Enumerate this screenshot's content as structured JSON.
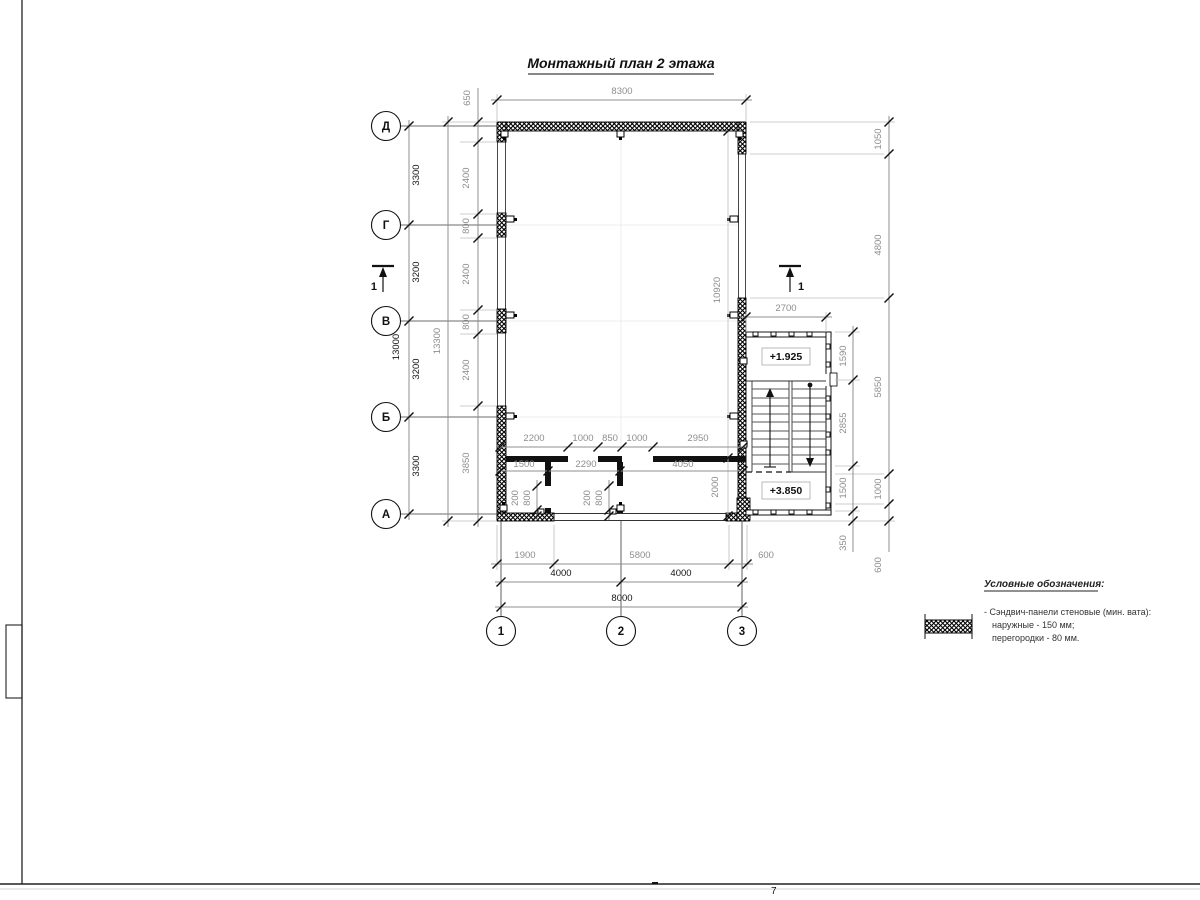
{
  "title": "Монтажный план 2 этажа",
  "axes": {
    "rows": [
      "Д",
      "Г",
      "В",
      "Б",
      "А"
    ],
    "cols": [
      "1",
      "2",
      "3"
    ]
  },
  "section_mark": "1",
  "levels": {
    "upper": "+1.925",
    "lower": "+3.850"
  },
  "dims": {
    "top_width": "8300",
    "left_axis": [
      "3300",
      "3200",
      "3200",
      "3300"
    ],
    "left_axis_total": "13000",
    "left_overall": "13300",
    "left_wall": [
      "650",
      "2400",
      "800",
      "2400",
      "800",
      "2400",
      "3850"
    ],
    "right_outer": [
      "1050",
      "4800",
      "5850",
      "1000",
      "600"
    ],
    "right_inner": [
      "1590",
      "2855",
      "1500",
      "350"
    ],
    "stair_width": "2700",
    "hall_depth": "10920",
    "room_depth": "2000",
    "partition_row1": [
      "2200",
      "1000",
      "850",
      "1000",
      "2950"
    ],
    "partition_row2": [
      "1500",
      "2290",
      "4050"
    ],
    "stub1": [
      "200",
      "800"
    ],
    "stub2": [
      "200",
      "800"
    ],
    "bottom_row1": [
      "1900",
      "5800",
      "600"
    ],
    "bottom_row2": [
      "4000",
      "4000"
    ],
    "bottom_total": "8000"
  },
  "legend": {
    "title": "Условные обозначения:",
    "item_line1": "- Сэндвич-панели стеновые (мин. вата):",
    "item_line2": "наружные - 150 мм;",
    "item_line3": "перегородки - 80 мм."
  },
  "sheet": {
    "page_number": "7"
  }
}
